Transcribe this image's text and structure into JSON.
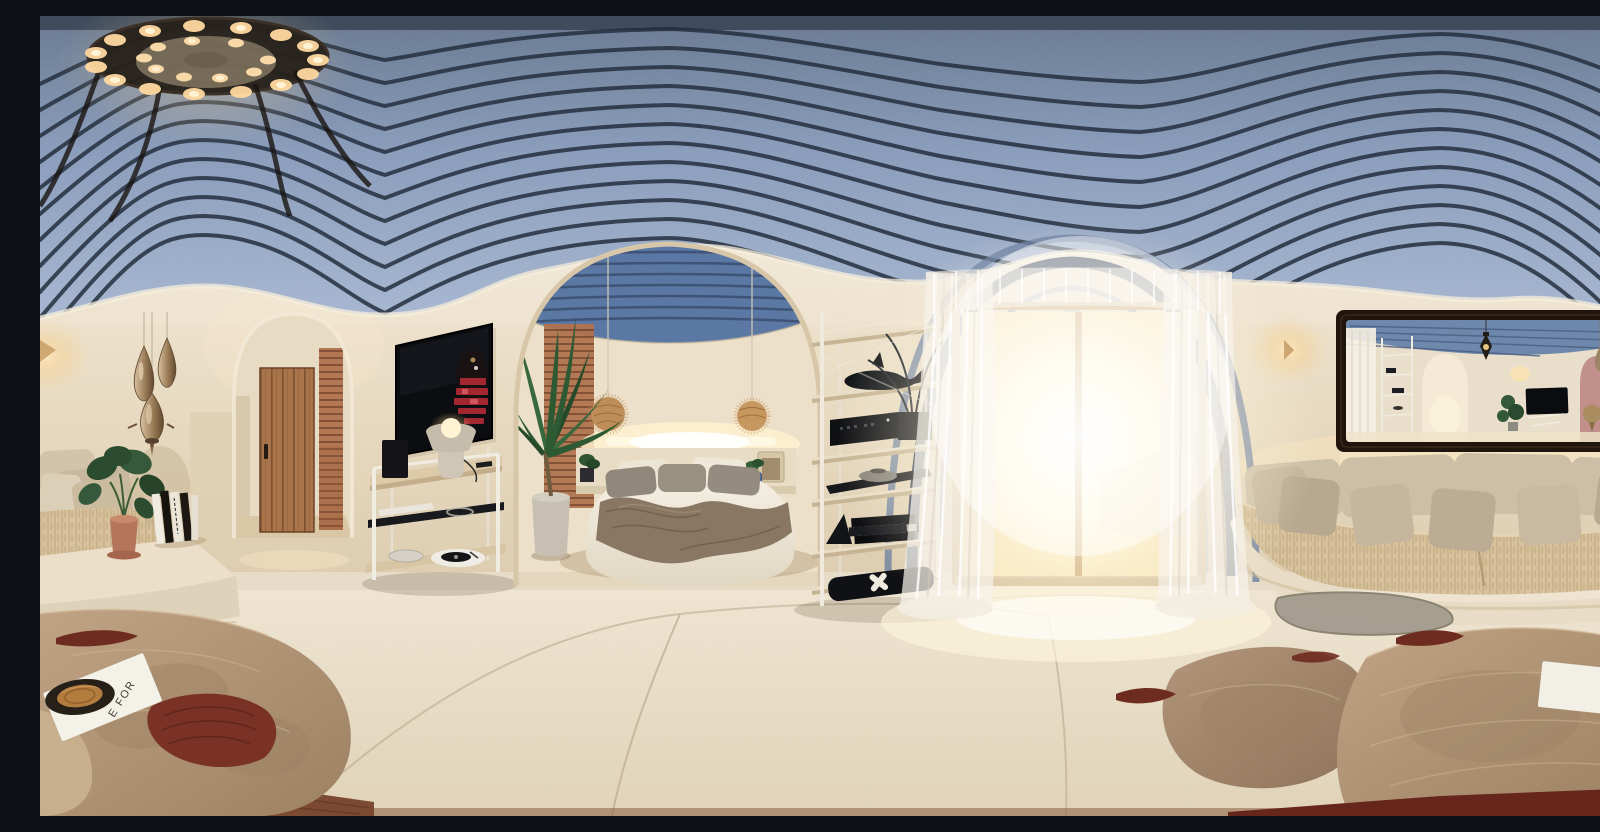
{
  "meta": {
    "title": "360-degree equirectangular panorama of a Santorini-style suite: blue ribbed vaulted ceiling, arched bed alcove, sheer-curtained glass door, curved built-in sofas and travertine stone tables",
    "type": "equirectangular-panorama",
    "width_px": 1600,
    "height_px": 800
  },
  "texts": {
    "magazine_partial": "E FOR",
    "tv_screen_text": "illegible mirrored red text"
  },
  "palette": {
    "ceiling_blue": "#8296b6",
    "rib_dark": "#25303f",
    "wall_cream": "#e9ddc6",
    "floor_cream": "#e7dcc5",
    "stone_tan": "#b09474",
    "accent_maroon": "#6e2b1f",
    "door_wood": "#a9744a",
    "terracotta": "#b0724e",
    "rattan": "#c08f58",
    "metal_bronze": "#a88a64",
    "sofa_beige": "#cdbea6",
    "black_decor": "#131418",
    "glow_warm": "#ffe3ac",
    "daylight_white": "#fff9e8",
    "mirror_frame": "#20150d"
  },
  "scene": {
    "regions": [
      {
        "id": "ceiling",
        "label": "steel-blue ribbed vaulted ceiling with round multi-bulb chandelier"
      },
      {
        "id": "left-lounge",
        "label": "corner bench sofa with monstera plant, book stack and metallic teardrop pendant lamps"
      },
      {
        "id": "hallway",
        "label": "arched hallway with wooden plank door and terracotta lattice panel"
      },
      {
        "id": "media-wall",
        "label": "wall-mounted TV above white console with lamp, speaker and turntable"
      },
      {
        "id": "bed-alcove",
        "label": "arched sleeping alcove with platform bed, rattan pendants, cove lighting and potted palm"
      },
      {
        "id": "shelving",
        "label": "open shelving unit with black decor objects"
      },
      {
        "id": "window-bay",
        "label": "bright glass door with sheer white curtains"
      },
      {
        "id": "mirror-wall",
        "label": "dark-framed wall mirror reflecting the suite, flanked by warm sconces"
      },
      {
        "id": "sofa-right",
        "label": "long curved built-in sofa with woven seat cushions and taupe pillows"
      },
      {
        "id": "floor",
        "label": "cream stone floor with organic travertine low tables and maroon accents"
      }
    ]
  }
}
